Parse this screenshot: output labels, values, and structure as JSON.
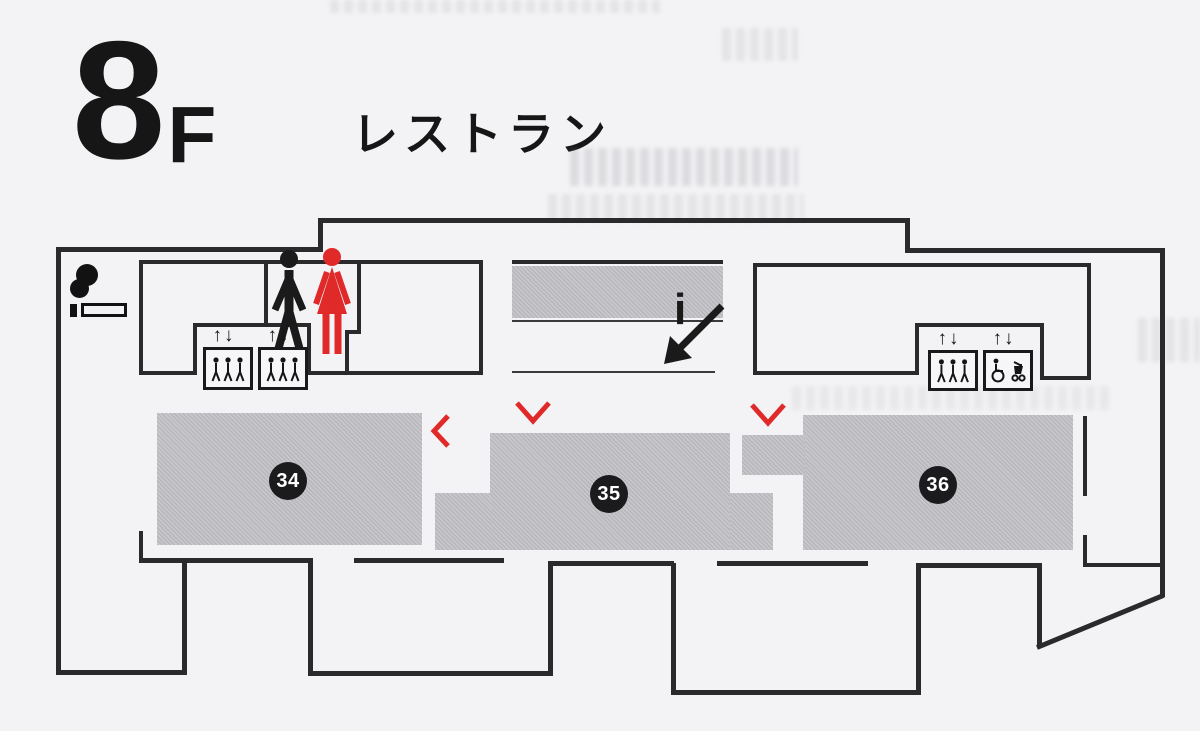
{
  "header": {
    "floor_number": "8",
    "floor_letter": "F",
    "category_title": "レストラン"
  },
  "rooms": [
    {
      "number": "34"
    },
    {
      "number": "35"
    },
    {
      "number": "36"
    }
  ],
  "elevators": {
    "updown_label": "↑↓"
  },
  "escalator": {
    "info_label": "i"
  },
  "icons": {
    "smoking": "smoking-area-icon",
    "mens_restroom": "mens-restroom-icon",
    "womens_restroom": "womens-restroom-icon",
    "elevator": "elevator-icon",
    "accessible_elevator": "accessible-elevator-icon",
    "escalator_down": "escalator-down-arrow-icon",
    "information": "info-icon",
    "direction": "direction-chevron-icon"
  },
  "colors": {
    "accent_red": "#e02a2a",
    "wall_black": "#2a2a2c",
    "room_gray": "#bdbdc1",
    "badge_black": "#1b1b1d",
    "background": "#f3f3f5"
  }
}
